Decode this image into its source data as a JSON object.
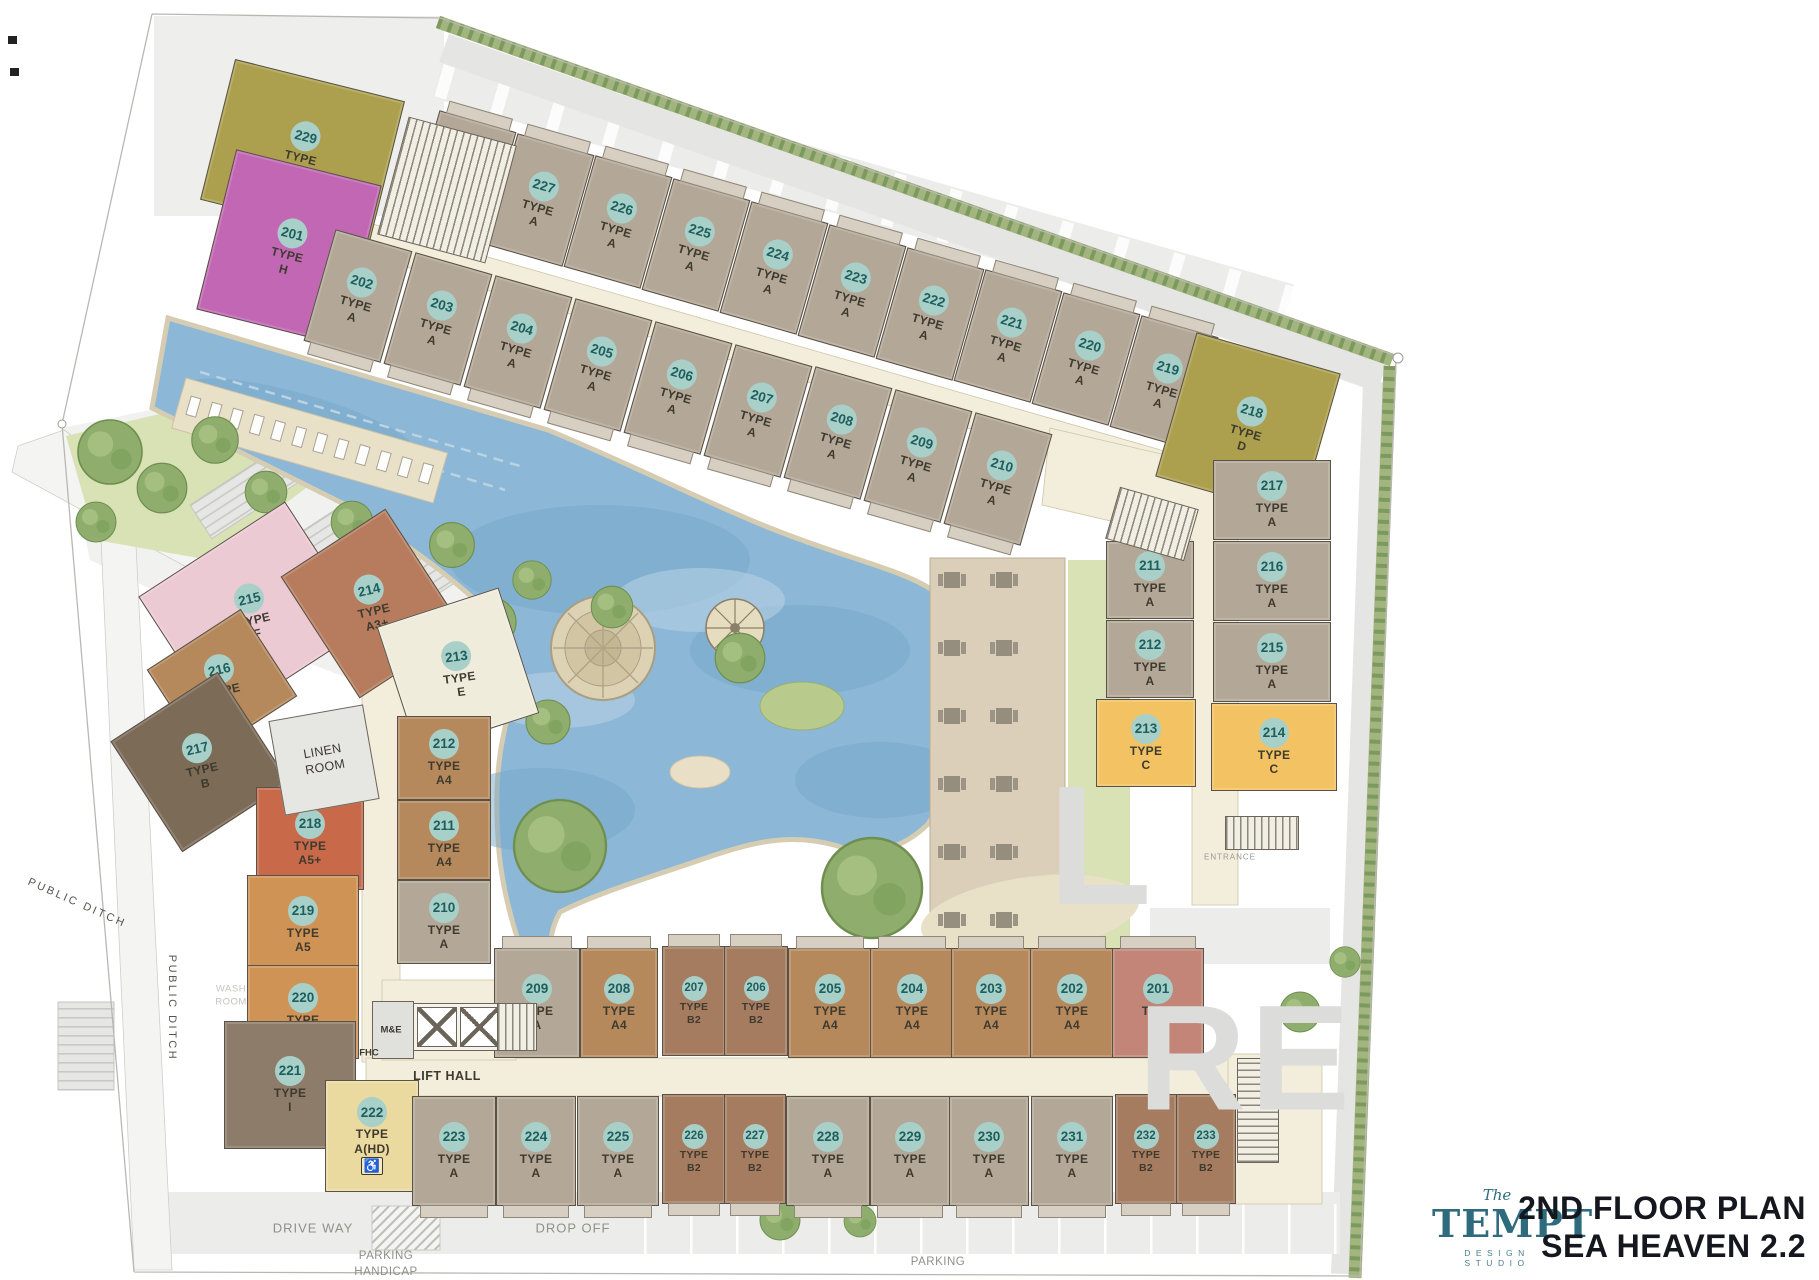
{
  "meta": {
    "title_line1": "2ND FLOOR PLAN",
    "title_line2": "SEA HEAVEN 2.2",
    "logo": {
      "the": "The",
      "name": "TEMPT",
      "sub": "DESIGN STUDIO"
    }
  },
  "labels": {
    "type_word": "TYPE",
    "hd_icon": "♿"
  },
  "palette": {
    "number_circle": "#a9cfc9",
    "number_text": "#1c5f5c",
    "type_text": "#3e3a2f",
    "wall": "#5a5247",
    "corridor": "#f2eedb",
    "pool": "#8cb7d7",
    "pool_edge": "#d5ccb2",
    "deck": "#dbcfba",
    "grass": "#d8e2b4",
    "hedge": "#a3b57f",
    "road": "#ececea",
    "logo_teal": "#2e6b7d",
    "title_ink": "#15171e",
    "type_colors": {
      "A": "#b3a797",
      "A4": "#b5895c",
      "A5": "#d09356",
      "A5+": "#c8694a",
      "A3": "#c28577",
      "A3+": "#b77c5e",
      "A(HD)": "#eada9f",
      "B": "#7c6b57",
      "B2": "#a57c60",
      "C": "#f3c363",
      "D": "#aca04f",
      "E": "#efecdc",
      "F": "#eccad3",
      "G": "#aca04f",
      "H": "#c167b4",
      "I": "#8d7c6a"
    }
  },
  "units": [
    {
      "n": "229",
      "t": "G",
      "x": 302,
      "y": 150,
      "w": 175,
      "h": 145,
      "r": 14
    },
    {
      "n": "201",
      "t": "H",
      "x": 289,
      "y": 247,
      "w": 150,
      "h": 165,
      "r": 14
    },
    {
      "n": "228",
      "t": "A",
      "x": 462,
      "y": 177,
      "w": 80,
      "h": 116,
      "r": 16,
      "p": "t"
    },
    {
      "n": "227",
      "t": "A",
      "x": 540,
      "y": 200,
      "w": 80,
      "h": 116,
      "r": 16,
      "p": "t"
    },
    {
      "n": "226",
      "t": "A",
      "x": 618,
      "y": 222,
      "w": 80,
      "h": 116,
      "r": 16,
      "p": "t"
    },
    {
      "n": "225",
      "t": "A",
      "x": 696,
      "y": 245,
      "w": 80,
      "h": 116,
      "r": 16,
      "p": "t"
    },
    {
      "n": "224",
      "t": "A",
      "x": 774,
      "y": 268,
      "w": 80,
      "h": 116,
      "r": 16,
      "p": "t"
    },
    {
      "n": "223",
      "t": "A",
      "x": 852,
      "y": 291,
      "w": 80,
      "h": 116,
      "r": 16,
      "p": "t"
    },
    {
      "n": "222",
      "t": "A",
      "x": 930,
      "y": 314,
      "w": 80,
      "h": 116,
      "r": 16,
      "p": "t"
    },
    {
      "n": "221",
      "t": "A",
      "x": 1008,
      "y": 336,
      "w": 80,
      "h": 116,
      "r": 16,
      "p": "t"
    },
    {
      "n": "220",
      "t": "A",
      "x": 1086,
      "y": 359,
      "w": 80,
      "h": 116,
      "r": 16,
      "p": "t"
    },
    {
      "n": "219",
      "t": "A",
      "x": 1164,
      "y": 382,
      "w": 80,
      "h": 116,
      "r": 16,
      "p": "t"
    },
    {
      "n": "218",
      "t": "D",
      "x": 1248,
      "y": 425,
      "w": 150,
      "h": 150,
      "r": 16
    },
    {
      "n": "202",
      "t": "A",
      "x": 358,
      "y": 296,
      "w": 80,
      "h": 116,
      "r": 16,
      "p": "b"
    },
    {
      "n": "203",
      "t": "A",
      "x": 438,
      "y": 319,
      "w": 80,
      "h": 116,
      "r": 16,
      "p": "b"
    },
    {
      "n": "204",
      "t": "A",
      "x": 518,
      "y": 342,
      "w": 80,
      "h": 116,
      "r": 16,
      "p": "b"
    },
    {
      "n": "205",
      "t": "A",
      "x": 598,
      "y": 365,
      "w": 80,
      "h": 116,
      "r": 16,
      "p": "b"
    },
    {
      "n": "206",
      "t": "A",
      "x": 678,
      "y": 388,
      "w": 80,
      "h": 116,
      "r": 16,
      "p": "b"
    },
    {
      "n": "207",
      "t": "A",
      "x": 758,
      "y": 411,
      "w": 80,
      "h": 116,
      "r": 16,
      "p": "b"
    },
    {
      "n": "208",
      "t": "A",
      "x": 838,
      "y": 433,
      "w": 80,
      "h": 116,
      "r": 16,
      "p": "b"
    },
    {
      "n": "209",
      "t": "A",
      "x": 918,
      "y": 456,
      "w": 80,
      "h": 116,
      "r": 16,
      "p": "b"
    },
    {
      "n": "210",
      "t": "A",
      "x": 998,
      "y": 479,
      "w": 80,
      "h": 116,
      "r": 16,
      "p": "b"
    },
    {
      "n": "217",
      "t": "A",
      "x": 1272,
      "y": 500,
      "w": 118,
      "h": 80,
      "r": 0
    },
    {
      "n": "216",
      "t": "A",
      "x": 1272,
      "y": 581,
      "w": 118,
      "h": 80,
      "r": 0
    },
    {
      "n": "215",
      "t": "A",
      "x": 1272,
      "y": 662,
      "w": 118,
      "h": 80,
      "r": 0
    },
    {
      "n": "214",
      "t": "C",
      "x": 1274,
      "y": 747,
      "w": 126,
      "h": 88,
      "r": 0
    },
    {
      "n": "211",
      "t": "A",
      "x": 1150,
      "y": 580,
      "w": 88,
      "h": 78,
      "r": 0
    },
    {
      "n": "212",
      "t": "A",
      "x": 1150,
      "y": 659,
      "w": 88,
      "h": 78,
      "r": 0
    },
    {
      "n": "213",
      "t": "C",
      "x": 1146,
      "y": 743,
      "w": 100,
      "h": 88,
      "r": 0
    },
    {
      "n": "215",
      "t": "F",
      "x": 252,
      "y": 612,
      "w": 175,
      "h": 150,
      "r": -33,
      "tr": 20
    },
    {
      "n": "214",
      "t": "A3+",
      "x": 372,
      "y": 603,
      "w": 125,
      "h": 145,
      "r": -33,
      "tr": 20
    },
    {
      "n": "213",
      "t": "E",
      "x": 458,
      "y": 670,
      "w": 128,
      "h": 132,
      "r": -18,
      "tr": 10
    },
    {
      "n": "216",
      "t": "A4",
      "x": 222,
      "y": 683,
      "w": 112,
      "h": 104,
      "r": -33,
      "tr": 20
    },
    {
      "n": "217",
      "t": "B",
      "x": 200,
      "y": 762,
      "w": 128,
      "h": 132,
      "r": -33,
      "tr": 20
    },
    {
      "n": "218",
      "t": "A5+",
      "x": 310,
      "y": 838,
      "w": 108,
      "h": 103,
      "r": 0
    },
    {
      "n": "219",
      "t": "A5",
      "x": 303,
      "y": 925,
      "w": 112,
      "h": 100,
      "r": 0
    },
    {
      "n": "220",
      "t": "A5",
      "x": 303,
      "y": 1012,
      "w": 112,
      "h": 94,
      "r": 0
    },
    {
      "n": "221",
      "t": "I",
      "x": 290,
      "y": 1085,
      "w": 132,
      "h": 128,
      "r": 0
    },
    {
      "n": "222",
      "t": "A(HD)",
      "x": 372,
      "y": 1136,
      "w": 94,
      "h": 112,
      "r": 0,
      "hd": true
    },
    {
      "n": "212",
      "t": "A4",
      "x": 444,
      "y": 758,
      "w": 94,
      "h": 84,
      "r": 0
    },
    {
      "n": "211",
      "t": "A4",
      "x": 444,
      "y": 840,
      "w": 94,
      "h": 80,
      "r": 0
    },
    {
      "n": "210",
      "t": "A",
      "x": 444,
      "y": 922,
      "w": 94,
      "h": 84,
      "r": 0
    },
    {
      "n": "209",
      "t": "A",
      "x": 537,
      "y": 1003,
      "w": 86,
      "h": 110,
      "r": 0,
      "p": "t"
    },
    {
      "n": "208",
      "t": "A4",
      "x": 619,
      "y": 1003,
      "w": 78,
      "h": 110,
      "r": 0,
      "p": "t"
    },
    {
      "n": "207",
      "t": "B2",
      "x": 694,
      "y": 1001,
      "w": 64,
      "h": 110,
      "r": 0,
      "p": "t"
    },
    {
      "n": "206",
      "t": "B2",
      "x": 756,
      "y": 1001,
      "w": 64,
      "h": 110,
      "r": 0,
      "p": "t"
    },
    {
      "n": "205",
      "t": "A4",
      "x": 830,
      "y": 1003,
      "w": 84,
      "h": 110,
      "r": 0,
      "p": "t"
    },
    {
      "n": "204",
      "t": "A4",
      "x": 912,
      "y": 1003,
      "w": 84,
      "h": 110,
      "r": 0,
      "p": "t"
    },
    {
      "n": "203",
      "t": "A4",
      "x": 991,
      "y": 1003,
      "w": 80,
      "h": 110,
      "r": 0,
      "p": "t"
    },
    {
      "n": "202",
      "t": "A4",
      "x": 1072,
      "y": 1003,
      "w": 84,
      "h": 110,
      "r": 0,
      "p": "t"
    },
    {
      "n": "201",
      "t": "A3",
      "x": 1158,
      "y": 1003,
      "w": 92,
      "h": 110,
      "r": 0,
      "p": "t"
    },
    {
      "n": "223",
      "t": "A",
      "x": 454,
      "y": 1151,
      "w": 84,
      "h": 110,
      "r": 0,
      "p": "b"
    },
    {
      "n": "224",
      "t": "A",
      "x": 536,
      "y": 1151,
      "w": 80,
      "h": 110,
      "r": 0,
      "p": "b"
    },
    {
      "n": "225",
      "t": "A",
      "x": 618,
      "y": 1151,
      "w": 82,
      "h": 110,
      "r": 0,
      "p": "b"
    },
    {
      "n": "226",
      "t": "B2",
      "x": 694,
      "y": 1149,
      "w": 64,
      "h": 110,
      "r": 0,
      "p": "b"
    },
    {
      "n": "227",
      "t": "B2",
      "x": 755,
      "y": 1149,
      "w": 62,
      "h": 110,
      "r": 0,
      "p": "b"
    },
    {
      "n": "228",
      "t": "A",
      "x": 828,
      "y": 1151,
      "w": 84,
      "h": 110,
      "r": 0,
      "p": "b"
    },
    {
      "n": "229",
      "t": "A",
      "x": 910,
      "y": 1151,
      "w": 80,
      "h": 110,
      "r": 0,
      "p": "b"
    },
    {
      "n": "230",
      "t": "A",
      "x": 989,
      "y": 1151,
      "w": 80,
      "h": 110,
      "r": 0,
      "p": "b"
    },
    {
      "n": "231",
      "t": "A",
      "x": 1072,
      "y": 1151,
      "w": 82,
      "h": 110,
      "r": 0,
      "p": "b"
    },
    {
      "n": "232",
      "t": "B2",
      "x": 1146,
      "y": 1149,
      "w": 62,
      "h": 110,
      "r": 0,
      "p": "b"
    },
    {
      "n": "233",
      "t": "B2",
      "x": 1206,
      "y": 1149,
      "w": 60,
      "h": 110,
      "r": 0,
      "p": "b"
    }
  ],
  "rooms": [
    {
      "kind": "stairs",
      "x": 447,
      "y": 190,
      "w": 112,
      "h": 122,
      "r": 15
    },
    {
      "kind": "stairs",
      "x": 1152,
      "y": 524,
      "w": 82,
      "h": 54,
      "r": 16
    },
    {
      "kind": "stairs",
      "x": 1262,
      "y": 833,
      "w": 74,
      "h": 34,
      "r": 0
    },
    {
      "kind": "lift",
      "x": 458,
      "y": 1027,
      "w": 90,
      "h": 48,
      "r": 0
    },
    {
      "kind": "stairs",
      "x": 517,
      "y": 1027,
      "w": 40,
      "h": 48,
      "r": 0
    },
    {
      "kind": "linen",
      "x": 324,
      "y": 760,
      "w": 96,
      "h": 96,
      "r": -10,
      "lines": [
        "LINEN",
        "ROOM"
      ]
    },
    {
      "kind": "plain",
      "x": 393,
      "y": 1030,
      "w": 42,
      "h": 58,
      "r": 0
    },
    {
      "kind": "stairs",
      "x": 1258,
      "y": 1110,
      "w": 42,
      "h": 105,
      "r": 0
    }
  ],
  "site_labels": [
    {
      "text": "PUBLIC DITCH",
      "x": 77,
      "y": 903,
      "r": 24,
      "size": 11,
      "ls": 2.5,
      "color": "#55544e"
    },
    {
      "text": "PUBLIC DITCH",
      "x": 172,
      "y": 1008,
      "r": 90,
      "size": 11,
      "ls": 2.5,
      "color": "#55544e"
    },
    {
      "text": "DRIVE WAY",
      "x": 313,
      "y": 1228,
      "r": 0,
      "size": 13,
      "ls": 1,
      "color": "#90908a"
    },
    {
      "text": "DROP OFF",
      "x": 573,
      "y": 1228,
      "r": 0,
      "size": 13,
      "ls": 1,
      "color": "#90908a"
    },
    {
      "text": "PARKING",
      "x": 386,
      "y": 1256,
      "r": 0,
      "size": 11.5,
      "ls": 0.5,
      "color": "#90908a"
    },
    {
      "text": "HANDICAP",
      "x": 386,
      "y": 1272,
      "r": 0,
      "size": 11.5,
      "ls": 0.5,
      "color": "#90908a"
    },
    {
      "text": "PARKING",
      "x": 938,
      "y": 1262,
      "r": 0,
      "size": 11.5,
      "ls": 0.5,
      "color": "#90908a"
    },
    {
      "text": "LIFT HALL",
      "x": 447,
      "y": 1076,
      "r": 0,
      "size": 12.5,
      "ls": 0.5,
      "color": "#3d3a31",
      "bold": true
    },
    {
      "text": "M&E",
      "x": 391,
      "y": 1030,
      "r": 0,
      "size": 9.5,
      "ls": 0,
      "color": "#3d3a31",
      "bold": true
    },
    {
      "text": "FHC",
      "x": 369,
      "y": 1053,
      "r": 0,
      "size": 9.5,
      "ls": 0,
      "color": "#3d3a31",
      "bold": true
    },
    {
      "text": "ENTRANCE",
      "x": 1230,
      "y": 857,
      "r": 0,
      "size": 8,
      "ls": 1,
      "color": "#9a9a94"
    },
    {
      "text": "WASH",
      "x": 231,
      "y": 989,
      "r": 0,
      "size": 9.5,
      "ls": 0.5,
      "color": "#c4c4bf"
    },
    {
      "text": "ROOM",
      "x": 231,
      "y": 1002,
      "r": 0,
      "size": 9.5,
      "ls": 0.5,
      "color": "#c4c4bf"
    }
  ],
  "watermark": [
    {
      "t": "L",
      "x": 1102,
      "y": 846,
      "size": 170
    },
    {
      "t": "RE",
      "x": 1246,
      "y": 1058,
      "size": 150
    }
  ]
}
